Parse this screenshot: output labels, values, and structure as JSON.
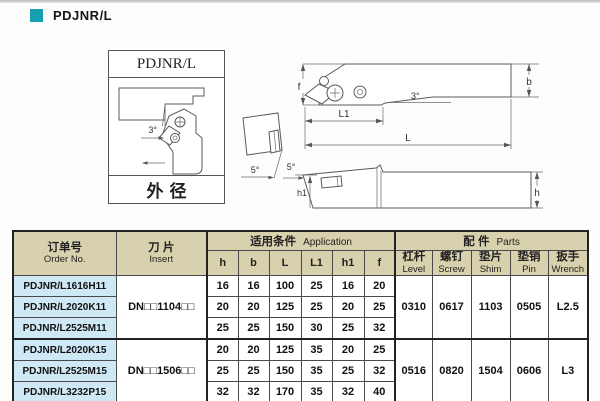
{
  "page": {
    "title": "PDJNR/L"
  },
  "colors": {
    "accent": "#16a0b2",
    "table_header_bg": "#d8d1ad",
    "order_col_bg": "#cfe8f5"
  },
  "diagram_box": {
    "title": "PDJNR/L",
    "caption": "外径",
    "angle": "3°"
  },
  "drawings": {
    "side_view": {
      "f": "f",
      "b": "b",
      "angle": "3°",
      "l1": "L1",
      "l": "L"
    },
    "top_view": {
      "angle_left": "5°",
      "angle_right": "5°",
      "h1": "h1",
      "h": "h"
    }
  },
  "table": {
    "headers": {
      "order_no": {
        "zh": "订单号",
        "en": "Order No."
      },
      "insert": {
        "zh": "刀 片",
        "en": "Insert"
      },
      "application": {
        "zh": "适用条件",
        "en": "Application"
      },
      "parts": {
        "zh": "配 件",
        "en": "Parts"
      },
      "app_cols": [
        "h",
        "b",
        "L",
        "L1",
        "h1",
        "f"
      ],
      "parts_cols": [
        {
          "zh": "杠杆",
          "en": "Level"
        },
        {
          "zh": "螺钉",
          "en": "Screw"
        },
        {
          "zh": "垫片",
          "en": "Shim"
        },
        {
          "zh": "垫销",
          "en": "Pin"
        },
        {
          "zh": "扳手",
          "en": "Wrench"
        }
      ]
    },
    "groups": [
      {
        "insert": "DN□□1104□□",
        "parts": [
          "0310",
          "0617",
          "1103",
          "0505",
          "L2.5"
        ],
        "rows": [
          {
            "order": "PDJNR/L1616H11",
            "values": [
              "16",
              "16",
              "100",
              "25",
              "16",
              "20"
            ]
          },
          {
            "order": "PDJNR/L2020K11",
            "values": [
              "20",
              "20",
              "125",
              "25",
              "20",
              "25"
            ]
          },
          {
            "order": "PDJNR/L2525M11",
            "values": [
              "25",
              "25",
              "150",
              "30",
              "25",
              "32"
            ]
          }
        ]
      },
      {
        "insert": "DN□□1506□□",
        "parts": [
          "0516",
          "0820",
          "1504",
          "0606",
          "L3"
        ],
        "rows": [
          {
            "order": "PDJNR/L2020K15",
            "values": [
              "20",
              "20",
              "125",
              "35",
              "20",
              "25"
            ]
          },
          {
            "order": "PDJNR/L2525M15",
            "values": [
              "25",
              "25",
              "150",
              "35",
              "25",
              "32"
            ]
          },
          {
            "order": "PDJNR/L3232P15",
            "values": [
              "32",
              "32",
              "170",
              "35",
              "32",
              "40"
            ]
          }
        ]
      }
    ]
  }
}
